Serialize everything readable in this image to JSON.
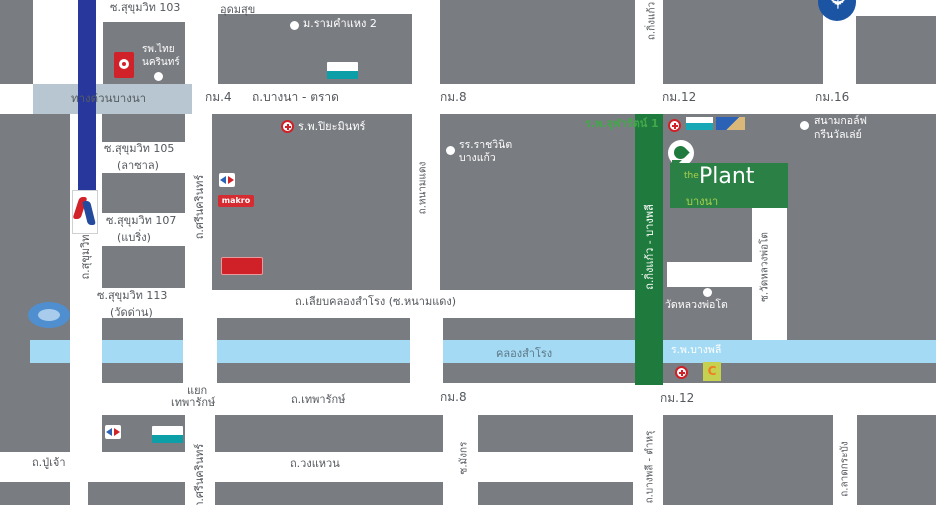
{
  "colors": {
    "block_gray": "#797c80",
    "road_white": "#ffffff",
    "canal_blue": "#a4daf3",
    "expressway_band": "#b7c6d0",
    "transit_blue": "#27379c",
    "route_green": "#1e7b3d",
    "plant_green": "#2b8046",
    "accent_green": "#43a74c",
    "hospital_red": "#cf2127",
    "label_dark": "#54585d"
  },
  "plant": {
    "the": "the",
    "name": "Plant",
    "area": "บางนา"
  },
  "roads": {
    "soi103": "ซ.สุขุมวิท 103",
    "udomsuk": "อุดมสุข",
    "soi105a": "ซ.สุขุมวิท 105",
    "soi105b": "(ลาซาล)",
    "soi107a": "ซ.สุขุมวิท 107",
    "soi107b": "(แบริ่ง)",
    "soi113a": "ซ.สุขุมวิท 113",
    "soi113b": "(วัดด่าน)",
    "expressway": "ทางด่วนบางนา",
    "bangna_trad": "ถ.บางนา - ตราด",
    "km4": "กม.4",
    "km8": "กม.8",
    "km12": "กม.12",
    "km16": "กม.16",
    "km8b": "กม.8",
    "km12b": "กม.12",
    "sukhumvit": "ถ.สุขุมวิท",
    "srinagarindra": "ถ.ศรีนครินทร์",
    "srinagarindra2": "ถ.ศรีนครินทร์",
    "namdaeng": "ถ.หนามแดง",
    "kingkaew": "ถ.กิ่งแก้ว",
    "kingkaew_bangplee": "ถ.กิ่งแก้ว - บางพลี",
    "liab_klong": "ถ.เลียบคลองสำโรง (ซ.หนามแดง)",
    "yaek_line1": "แยก",
    "yaek_line2": "เทพารักษ์",
    "theparak": "ถ.เทพารักษ์",
    "wongwaen": "ถ.วงแหวน",
    "puchao": "ถ.ปู่เจ้า",
    "mangkon": "ซ.มังกร",
    "wat_luang_pho_to_soi": "ซ.วัดหลวงพ่อโต",
    "bangplee_tamru": "ถ.บางพลี - ตำหรุ",
    "ladkrabang": "ถ.ลาดกระบัง"
  },
  "canal": {
    "name": "คลองสำโรง"
  },
  "places": {
    "ramkhamhaeng": "ม.รามคำแหง 2",
    "thai_nakarin1": "รพ.ไทย",
    "thai_nakarin2": "นครินทร์",
    "piyamin": "ร.พ.ปิยะมินทร์",
    "rajwinit1": "รร.ราชวินิต",
    "rajwinit2": "บางแก้ว",
    "chularat": "ร.พ.จุฬารัตน์ 1",
    "golf1": "สนามกอล์ฟ",
    "golf2": "กรีนวัลเล่ย์",
    "wat_luang_pho_to": "วัดหลวงพ่อโต",
    "bangplee_hospital": "ร.พ.บางพลี"
  },
  "logos": {
    "makro": "makro",
    "big_c": "C"
  },
  "icons": {
    "airplane": "✈"
  }
}
